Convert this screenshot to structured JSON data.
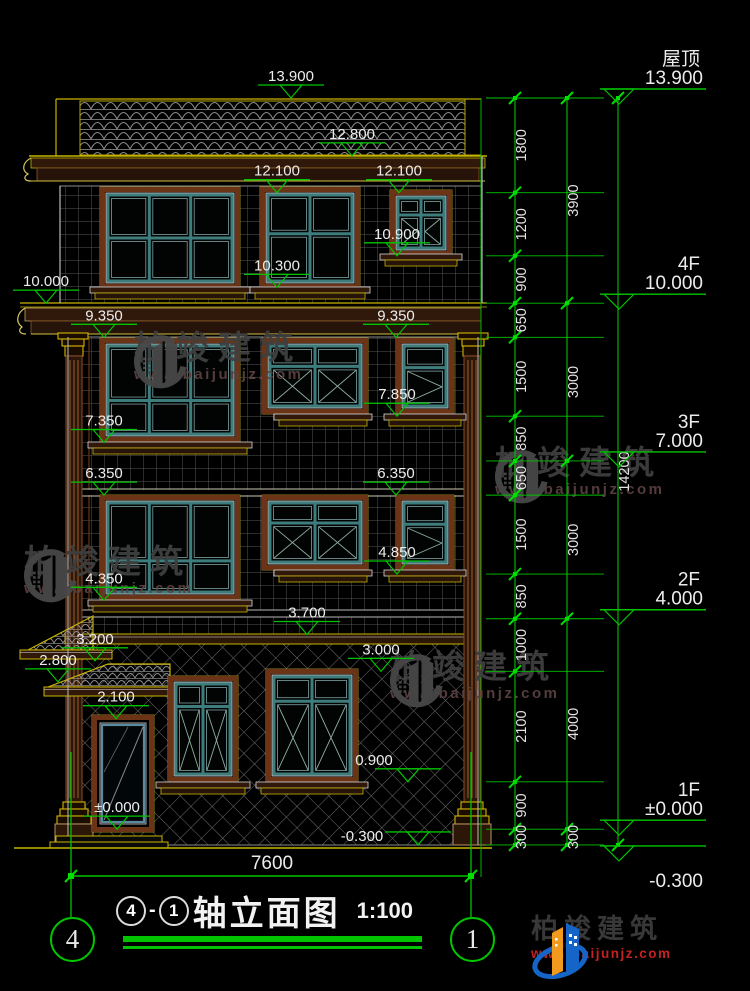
{
  "title_block": {
    "axis_start": "4",
    "separator": "-",
    "axis_end": "1",
    "name": "轴立面图",
    "scale": "1:100"
  },
  "axis_bubbles": {
    "left": "4",
    "right": "1"
  },
  "floor_markers": [
    {
      "label": "屋顶",
      "value": "13.900",
      "elev": 13.9
    },
    {
      "label": "4F",
      "value": "10.000",
      "elev": 10.0
    },
    {
      "label": "3F",
      "value": "7.000",
      "elev": 7.0
    },
    {
      "label": "2F",
      "value": "4.000",
      "elev": 4.0
    },
    {
      "label": "1F",
      "value": "±0.000",
      "elev": 0.0
    },
    {
      "label": "",
      "value": "-0.300",
      "elev": -0.3,
      "text_below": true,
      "dy": 10
    }
  ],
  "elevation_markers": [
    {
      "value": "13.900",
      "elev": 13.9,
      "x": 291
    },
    {
      "value": "12.800",
      "elev": 12.8,
      "x": 352
    },
    {
      "value": "12.100",
      "elev": 12.1,
      "x": 277
    },
    {
      "value": "12.100",
      "elev": 12.1,
      "x": 399
    },
    {
      "value": "10.300",
      "elev": 10.3,
      "x": 277
    },
    {
      "value": "10.900",
      "elev": 10.9,
      "x": 397
    },
    {
      "value": "10.000",
      "elev": 10.0,
      "x": 46
    },
    {
      "value": "9.350",
      "elev": 9.35,
      "x": 104
    },
    {
      "value": "9.350",
      "elev": 9.35,
      "x": 396
    },
    {
      "value": "7.350",
      "elev": 7.35,
      "x": 104
    },
    {
      "value": "7.850",
      "elev": 7.85,
      "x": 397
    },
    {
      "value": "6.350",
      "elev": 6.35,
      "x": 104
    },
    {
      "value": "6.350",
      "elev": 6.35,
      "x": 396
    },
    {
      "value": "4.350",
      "elev": 4.35,
      "x": 104
    },
    {
      "value": "4.850",
      "elev": 4.85,
      "x": 397
    },
    {
      "value": "3.700",
      "elev": 3.7,
      "x": 307
    },
    {
      "value": "3.200",
      "elev": 3.2,
      "x": 95
    },
    {
      "value": "2.800",
      "elev": 2.8,
      "x": 58
    },
    {
      "value": "2.100",
      "elev": 2.1,
      "x": 116
    },
    {
      "value": "3.000",
      "elev": 3.0,
      "x": 381
    },
    {
      "value": "0.900",
      "elev": 0.9,
      "x": 408,
      "tdx": -34
    },
    {
      "value": "±0.000",
      "elev": 0.0,
      "x": 117
    },
    {
      "value": "-0.300",
      "elev": -0.3,
      "x": 418,
      "tdx": -56,
      "tdy": 13
    }
  ],
  "dim_chains": [
    {
      "x": 515,
      "values": [
        "1800",
        "1200",
        "900",
        "650",
        "1500",
        "850",
        "650",
        "1500",
        "850",
        "1000",
        "2100",
        "900",
        "300"
      ]
    },
    {
      "x": 567,
      "values": [
        "3900",
        "3000",
        "3000",
        "4000",
        "300"
      ]
    },
    {
      "x": 618,
      "values": [
        "14200"
      ]
    }
  ],
  "bottom_dim": {
    "value": "7600"
  },
  "watermark": {
    "name": "柏竣建筑",
    "url": "www.baijunjz.com"
  },
  "logo": {
    "name": "柏竣建筑",
    "url": "www.baijunjz.com"
  },
  "colors": {
    "green": "#00c400",
    "bright_green": "#00e000",
    "yellow": "#c8b400",
    "teal": "#3e7d7d",
    "brown": "#6b3416",
    "logo_blue": "#1565c8",
    "logo_orange": "#f29a1e",
    "logo_red": "#c42222"
  }
}
